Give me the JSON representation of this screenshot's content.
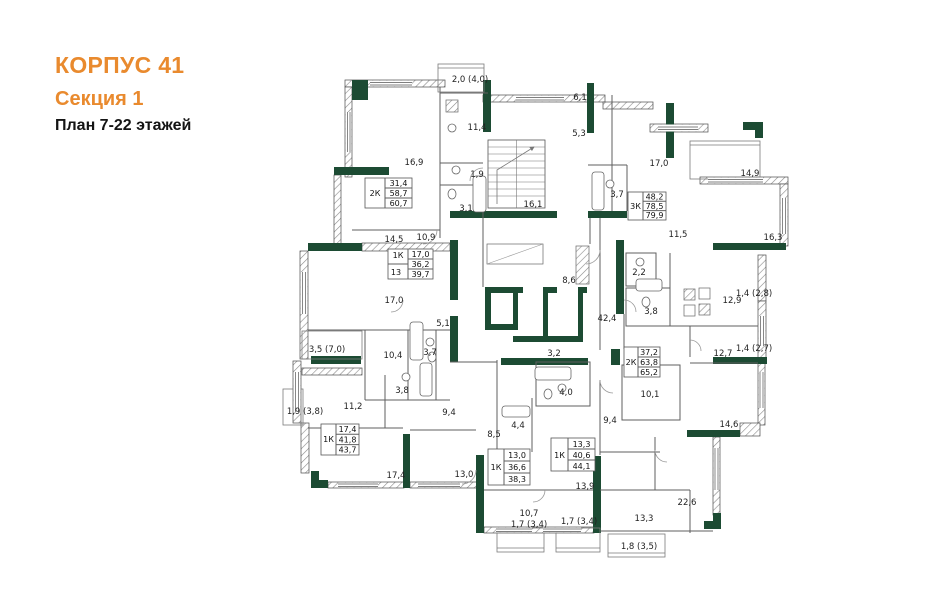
{
  "title": {
    "line1": "КОРПУС 41",
    "line2": "Секция 1",
    "line3": "План 7-22 этажей"
  },
  "colors": {
    "accent_orange": "#E98A2E",
    "wall_green": "#1C4B33",
    "wall_gray": "#4a4a4a",
    "background": "#ffffff"
  },
  "apartment_tables": [
    {
      "type": "2К",
      "num": "",
      "values": [
        "31,4",
        "58,7",
        "60,7"
      ]
    },
    {
      "type": "1К",
      "num": "13",
      "values": [
        "17,0",
        "36,2",
        "39,7"
      ]
    },
    {
      "type": "3К",
      "num": "",
      "values": [
        "48,2",
        "78,5",
        "79,9"
      ]
    },
    {
      "type": "2К",
      "num": "",
      "values": [
        "37,2",
        "63,8",
        "65,2"
      ]
    },
    {
      "type": "1К",
      "num": "",
      "values": [
        "17,4",
        "41,8",
        "43,7"
      ]
    },
    {
      "type": "1К",
      "num": "",
      "values": [
        "13,0",
        "36,6",
        "38,3"
      ]
    },
    {
      "type": "1К",
      "num": "",
      "values": [
        "13,3",
        "40,6",
        "44,1"
      ]
    }
  ],
  "room_labels": [
    {
      "id": "balcony-2-0",
      "text": "2,0 (4,0)"
    },
    {
      "id": "kitchen-11-4",
      "text": "11,4"
    },
    {
      "id": "hall-6-1",
      "text": "6,1"
    },
    {
      "id": "hall-5-3",
      "text": "5,3"
    },
    {
      "id": "room-16-9",
      "text": "16,9"
    },
    {
      "id": "wc-1-9",
      "text": "1,9"
    },
    {
      "id": "bath-3-1",
      "text": "3,1"
    },
    {
      "id": "stairhall-16-1",
      "text": "16,1"
    },
    {
      "id": "room-17-0-right",
      "text": "17,0"
    },
    {
      "id": "balcony-14-9",
      "text": "14,9"
    },
    {
      "id": "bath-3-7-right",
      "text": "3,7"
    },
    {
      "id": "room-16-3",
      "text": "16,3"
    },
    {
      "id": "room-11-5",
      "text": "11,5"
    },
    {
      "id": "hall-14-5",
      "text": "14,5"
    },
    {
      "id": "hall-10-9",
      "text": "10,9"
    },
    {
      "id": "room-17-0-left",
      "text": "17,0"
    },
    {
      "id": "lobby-8-6",
      "text": "8,6"
    },
    {
      "id": "wc-2-2",
      "text": "2,2"
    },
    {
      "id": "corridor-42-4",
      "text": "42,4"
    },
    {
      "id": "bath-3-8-right",
      "text": "3,8"
    },
    {
      "id": "hall-5-1",
      "text": "5,1"
    },
    {
      "id": "loggia-3-5",
      "text": "3,5 (7,0)"
    },
    {
      "id": "hall-10-4",
      "text": "10,4"
    },
    {
      "id": "bath-3-7-mid",
      "text": "3,7"
    },
    {
      "id": "bath-3-8-mid",
      "text": "3,8"
    },
    {
      "id": "hall-3-2",
      "text": "3,2"
    },
    {
      "id": "kitchen-12-9",
      "text": "12,9"
    },
    {
      "id": "shaft-1-4-2-8",
      "text": "1,4 (2,8)"
    },
    {
      "id": "room-12-7",
      "text": "12,7"
    },
    {
      "id": "shaft-1-4-2-7",
      "text": "1,4 (2,7)"
    },
    {
      "id": "room-10-1",
      "text": "10,1"
    },
    {
      "id": "balcony-1-9-3-8",
      "text": "1,9 (3,8)"
    },
    {
      "id": "room-11-2",
      "text": "11,2"
    },
    {
      "id": "hall-9-4-left",
      "text": "9,4"
    },
    {
      "id": "hall-8-5",
      "text": "8,5"
    },
    {
      "id": "bath-4-4",
      "text": "4,4"
    },
    {
      "id": "bath-4-0",
      "text": "4,0"
    },
    {
      "id": "hall-9-4-right",
      "text": "9,4"
    },
    {
      "id": "room-17-4",
      "text": "17,4"
    },
    {
      "id": "room-13-0",
      "text": "13,0"
    },
    {
      "id": "hall-13-9",
      "text": "13,9"
    },
    {
      "id": "room-10-7",
      "text": "10,7"
    },
    {
      "id": "balcony-1-7-a",
      "text": "1,7 (3,4)"
    },
    {
      "id": "balcony-1-7-b",
      "text": "1,7 (3,4)"
    },
    {
      "id": "room-13-3",
      "text": "13,3"
    },
    {
      "id": "balcony-1-8-3-5",
      "text": "1,8 (3,5)"
    },
    {
      "id": "room-22-6",
      "text": "22,6"
    },
    {
      "id": "room-14-6",
      "text": "14,6"
    }
  ]
}
